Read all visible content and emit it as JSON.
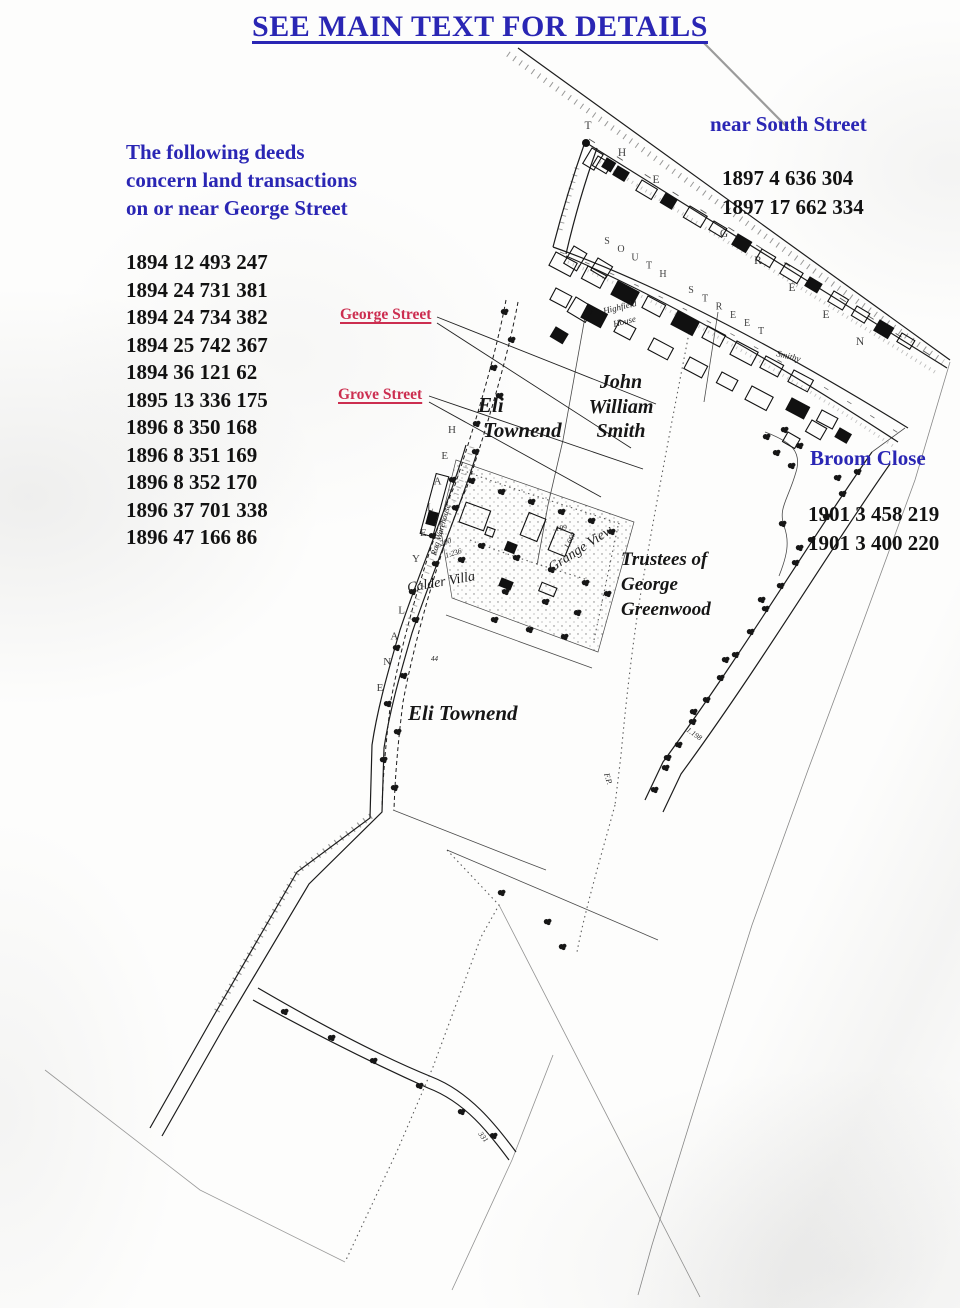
{
  "colors": {
    "annotation_blue": "#2a26b4",
    "deed_black": "#121212",
    "callout_red": "#cc2e50",
    "map_ink": "#1c1c1c"
  },
  "title": "SEE MAIN TEXT FOR DETAILS",
  "intro_note": {
    "line1": "The following deeds",
    "line2": "concern land transactions",
    "line3": "on or near George Street"
  },
  "george_street_deeds": [
    "1894 12 493 247",
    "1894 24 731 381",
    "1894 24 734 382",
    "1894 25 742 367",
    "1894 36 121 62",
    "1895 13 336 175",
    "1896 8 350 168",
    "1896 8 351 169",
    "1896 8 352 170",
    "1896 37 701 338",
    "1896 47 166 86"
  ],
  "south_street_note": {
    "heading": "near South Street",
    "deeds": [
      "1897 4 636 304",
      "1897 17 662 334"
    ]
  },
  "broom_close_note": {
    "heading": "Broom Close",
    "deeds": [
      "1901 3 458 219",
      "1901 3 400 220"
    ]
  },
  "street_callouts": {
    "george": "George Street",
    "grove": "Grove Street"
  },
  "owner_labels": {
    "eli_townend_upper": {
      "line1": "Eli",
      "line2": "Townend"
    },
    "john_william_smith": {
      "line1": "John",
      "line2": "William",
      "line3": "Smith"
    },
    "trustees_of_george_greenwood": {
      "line1": "Trustees of",
      "line2": "George",
      "line3": "Greenwood"
    },
    "eli_townend_lower": "Eli Townend"
  },
  "map_street_names": {
    "the_green": "THE GREEN",
    "south_street": "SOUTH STREET",
    "healey_lane": "HEALEY LANE"
  },
  "map_labels": {
    "highfield_house": {
      "line1": "Highfield",
      "line2": "House"
    },
    "smithy": "Smithy",
    "rag_warehouse": "Rag Warehouse",
    "calder_villa": "Calder Villa",
    "grange_view": "Grange View",
    "footpath": "F.P."
  },
  "map_numbers": {
    "n199": "199",
    "n1660": "1.660",
    "n200": "200",
    "n1236": "1.236",
    "n1198": "1.198",
    "n44": "44",
    "n331": "331"
  }
}
